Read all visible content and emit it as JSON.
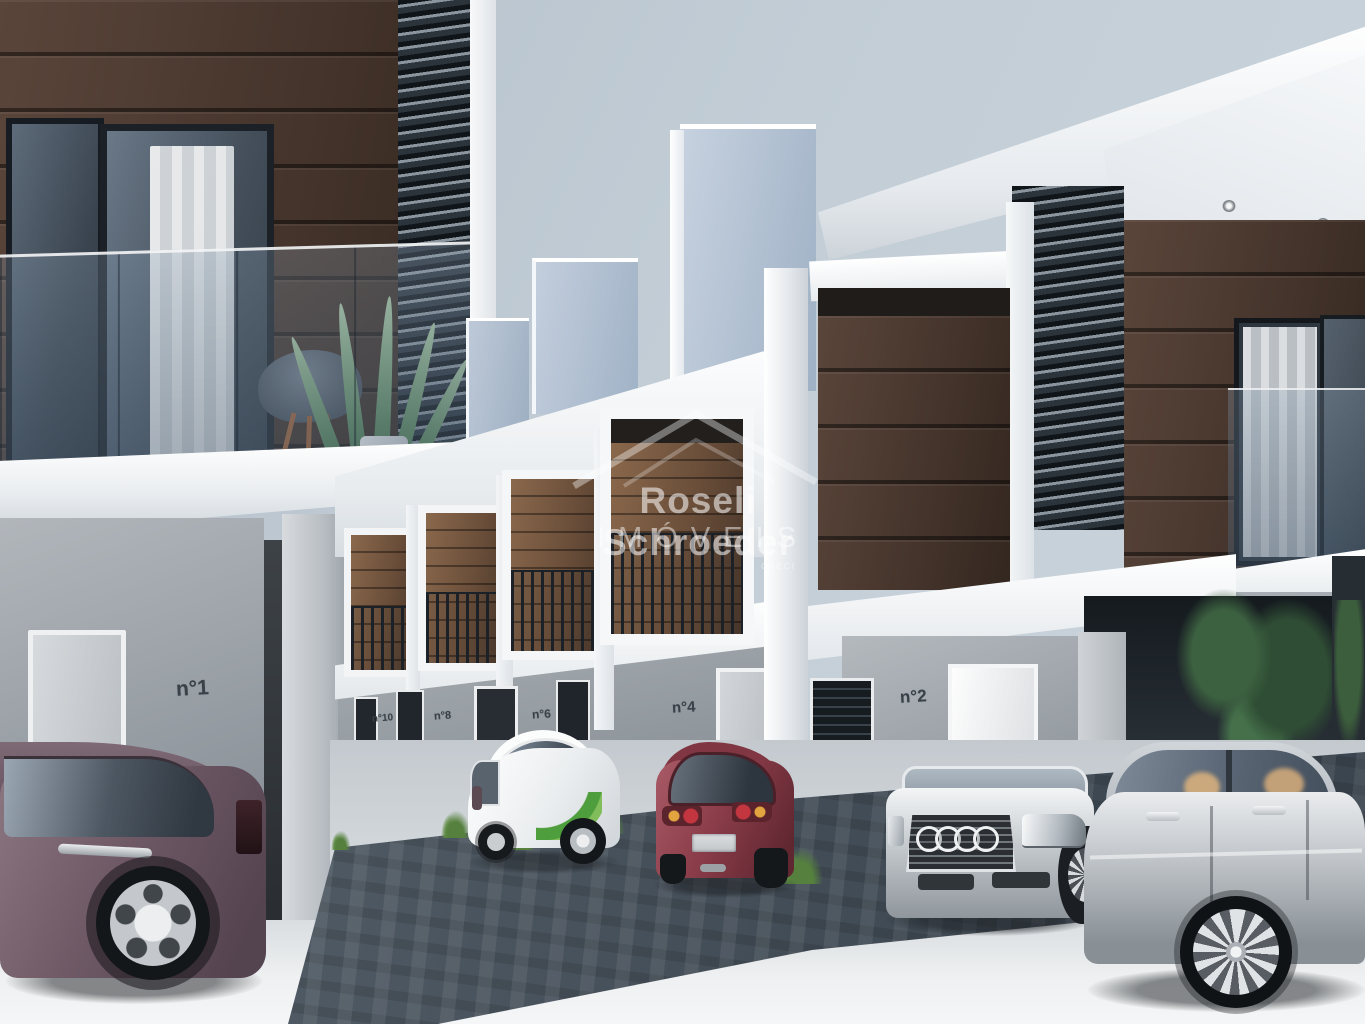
{
  "scene": {
    "description": "3D exterior rendering of a modern two-story townhouse condominium with carports, five parked cars and landscaping",
    "colors": {
      "sky": "#c3ced7",
      "wood_cladding": "#46352c",
      "white_structure": "#f2f4f6",
      "parapet_blue_gray": "#a9bacd",
      "lower_wall_gray": "#9aa1a8",
      "paving_dark": "#49535d",
      "concrete_light": "#e9ebed",
      "car_maroon": "#6d5864",
      "car_white": "#eef0f1",
      "car_red": "#8a3c49",
      "car_silver": "#c0c4c8",
      "decal_green": "#54a33e"
    }
  },
  "watermark": {
    "brand": "Roseli Schroeder",
    "brand_line2": "IMÓVEIS",
    "creci": "CRECI"
  },
  "house_numbers": {
    "unit1": "n°1",
    "unit10": "n°10",
    "unit8": "n°8",
    "unit6": "n°6",
    "unit4": "n°4",
    "unit2": "n°2"
  }
}
